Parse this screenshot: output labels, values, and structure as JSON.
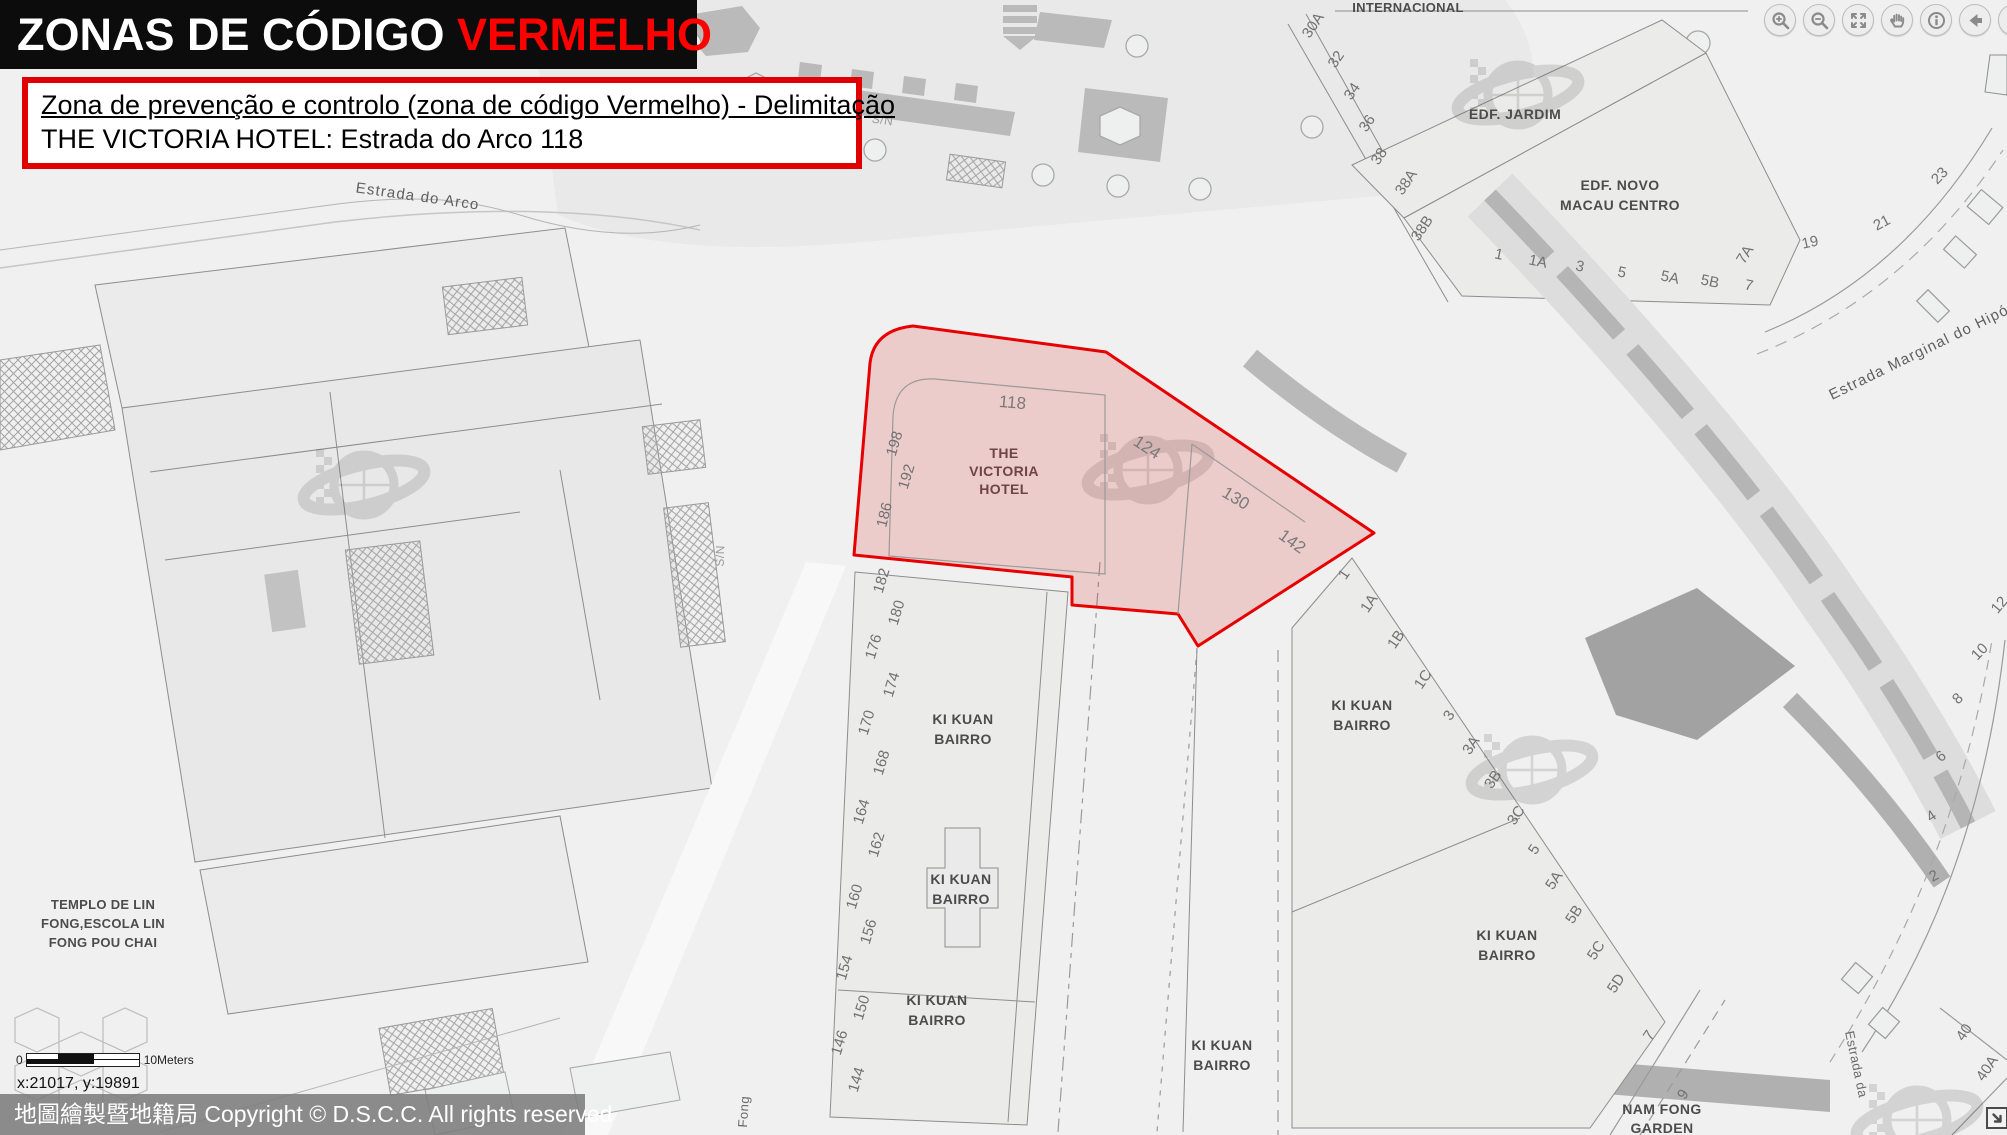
{
  "colors": {
    "title_accent": "#ff0000",
    "info_border": "#e00000",
    "zone_stroke": "#e60000",
    "zone_fill": "rgba(220,20,20,0.16)"
  },
  "header": {
    "title_prefix": "ZONAS DE CÓDIGO ",
    "title_accent": "VERMELHO"
  },
  "info_box": {
    "line1": "Zona de prevenção e controlo (zona de código Vermelho) - Delimitação",
    "line2": "THE VICTORIA HOTEL: Estrada do Arco 118"
  },
  "toolbar": {
    "icons": [
      {
        "name": "zoom-in"
      },
      {
        "name": "zoom-out"
      },
      {
        "name": "full-extent"
      },
      {
        "name": "pan"
      },
      {
        "name": "identify"
      },
      {
        "name": "back"
      },
      {
        "name": "forward"
      }
    ]
  },
  "scale_bar": {
    "zero": "0",
    "label": "10Meters"
  },
  "status": {
    "coordinates": "x:21017, y:19891"
  },
  "footer": {
    "copyright": "地圖繪製暨地籍局 Copyright © D.S.C.C. All rights reserved"
  },
  "map": {
    "zone": {
      "hotel_line1": "THE",
      "hotel_line2": "VICTORIA",
      "hotel_line3": "HOTEL",
      "n118": "118",
      "n124": "124",
      "n130": "130",
      "n142": "142",
      "n186": "186",
      "n192": "192",
      "n198": "198"
    },
    "streets": {
      "estrada_do_arco": "Estrada do Arco",
      "estrada_marginal": "Estrada Marginal do Hipódromo",
      "estrada_da": "Estrada da",
      "fong": "Fong",
      "sn": "S/N"
    },
    "places": {
      "internacional": "INTERNACIONAL",
      "edf_jardim": "EDF. JARDIM",
      "edf_novo_line1": "EDF. NOVO",
      "edf_novo_line2": "MACAU CENTRO",
      "templo_line1": "TEMPLO DE LIN",
      "templo_line2": "FONG,ESCOLA LIN",
      "templo_line3": "FONG POU CHAI",
      "ki_kuan_line1": "KI KUAN",
      "ki_kuan_line2": "BAIRRO",
      "nam_fong_line1": "NAM FONG",
      "nam_fong_line2": "GARDEN"
    },
    "house_numbers": {
      "left_street": [
        "182",
        "180",
        "176",
        "174",
        "170",
        "168",
        "164",
        "162",
        "160",
        "156",
        "154",
        "150",
        "146",
        "144"
      ],
      "top_right_diagonal": [
        "30A",
        "32",
        "34",
        "36",
        "38",
        "38A",
        "38B"
      ],
      "top_right_bottom": [
        "1",
        "1A",
        "3",
        "5",
        "5A",
        "5B",
        "7",
        "7A"
      ],
      "hipodromo_curve": [
        "19",
        "21",
        "23"
      ],
      "right_block_diagonal": [
        "1",
        "1A",
        "1B",
        "1C",
        "3",
        "3A",
        "3B",
        "3C",
        "5",
        "5A",
        "5B",
        "5C",
        "5D",
        "7",
        "9"
      ],
      "far_right_curve": [
        "12",
        "10",
        "8",
        "6",
        "4",
        "2"
      ],
      "bottom_right": [
        "40",
        "40A"
      ]
    }
  }
}
